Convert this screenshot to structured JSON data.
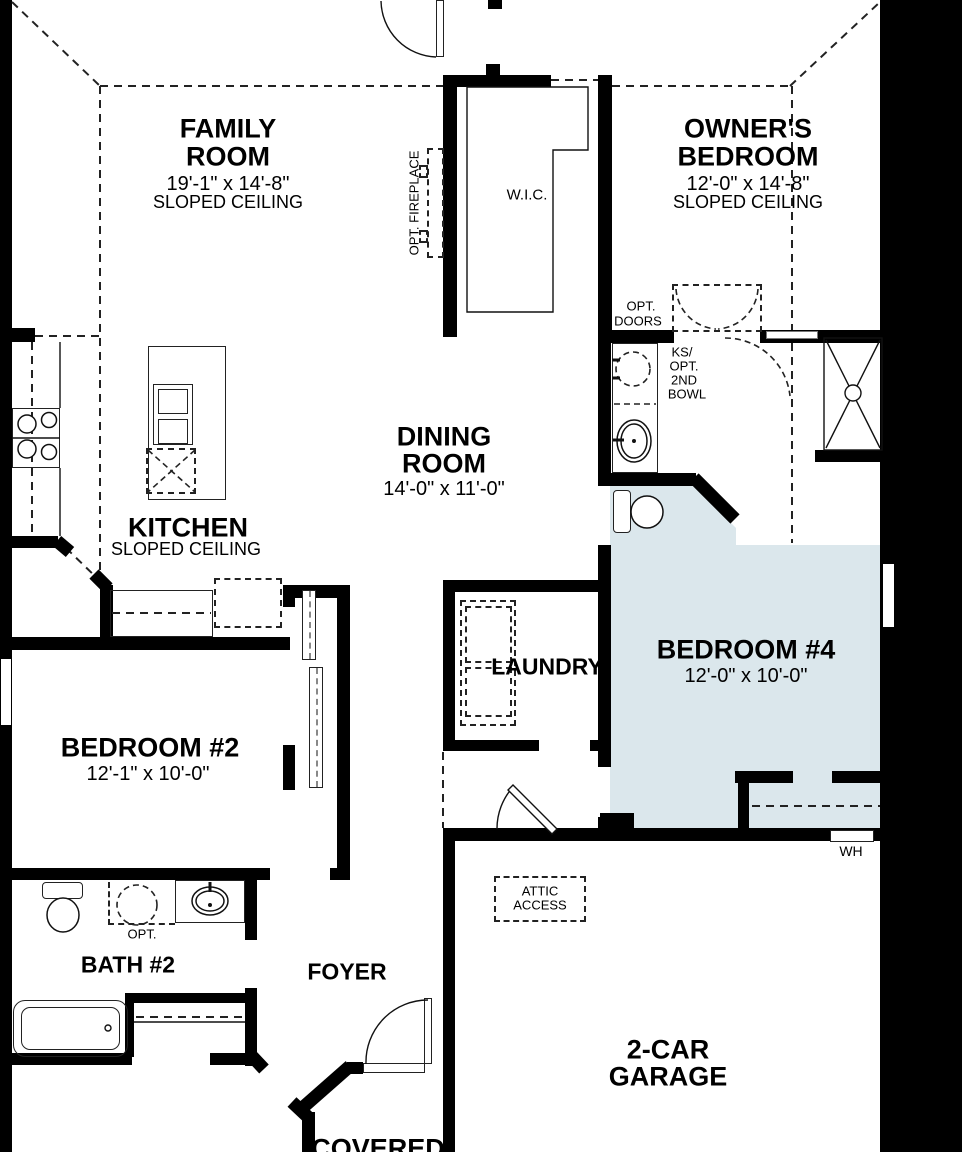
{
  "plan": {
    "rooms": {
      "family": {
        "name1": "FAMILY",
        "name2": "ROOM",
        "dims": "19'-1\" x 14'-8\"",
        "ceiling": "SLOPED CEILING"
      },
      "owners": {
        "name1": "OWNER'S",
        "name2": "BEDROOM",
        "dims": "12'-0\" x 14'-8\"",
        "ceiling": "SLOPED CEILING"
      },
      "dining": {
        "name1": "DINING",
        "name2": "ROOM",
        "dims": "14'-0\" x 11'-0\""
      },
      "kitchen": {
        "name": "KITCHEN",
        "ceiling": "SLOPED CEILING"
      },
      "bedroom2": {
        "name": "BEDROOM #2",
        "dims": "12'-1\" x 10'-0\""
      },
      "bedroom4": {
        "name": "BEDROOM #4",
        "dims": "12'-0\" x 10'-0\""
      },
      "laundry": {
        "name": "LAUNDRY"
      },
      "bath2": {
        "name": "BATH #2"
      },
      "foyer": {
        "name": "FOYER"
      },
      "garage": {
        "name1": "2-CAR",
        "name2": "GARAGE"
      },
      "covered": {
        "name": "COVERED"
      },
      "wic": {
        "name": "W.I.C."
      }
    },
    "labels": {
      "opt_fireplace": "OPT. FIREPLACE",
      "opt_doors1": "OPT.",
      "opt_doors2": "DOORS",
      "ks1": "KS/",
      "ks2": "OPT.",
      "ks3": "2ND",
      "ks4": "BOWL",
      "wh": "WH",
      "attic1": "ATTIC",
      "attic2": "ACCESS",
      "opt": "OPT."
    },
    "colors": {
      "wall": "#000000",
      "highlight": "#dbe7ec",
      "background": "#ffffff"
    }
  }
}
